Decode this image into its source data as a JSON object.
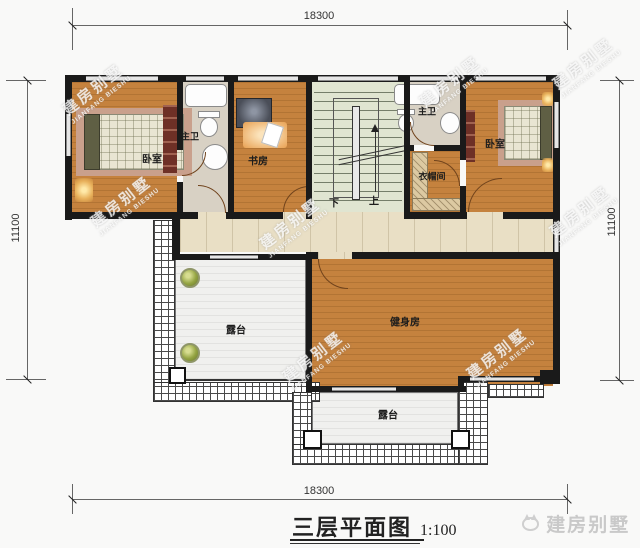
{
  "plan": {
    "title_text": "三层平面图",
    "title_scale": "1:100",
    "dimensions": {
      "top": "18300",
      "bottom": "18300",
      "left": "11100",
      "right": "11100"
    },
    "rooms": {
      "bedroom_left": "卧室",
      "bath_left": "主卫",
      "study": "书房",
      "bath_right": "主卫",
      "closet": "衣帽间",
      "bedroom_right": "卧室",
      "gym": "健身房",
      "terrace_left": "露台",
      "terrace_bottom": "露台"
    },
    "stairs": {
      "down": "下",
      "up": "上"
    },
    "watermark": {
      "line1": "建房别墅",
      "line2": "JIANFANG BIESHU"
    },
    "brand": {
      "text": "建房别墅"
    },
    "colors": {
      "wood_floor": "#c5823e",
      "hall_tile": "#e9dfc5",
      "stair_floor": "#e0e5d1",
      "bath_floor": "#d8d1c4",
      "terrace_floor": "#f0f0ee",
      "wall": "#1a1a1a",
      "shelf": "#dcc9a2",
      "brand_gray": "#c9c9c9"
    }
  }
}
